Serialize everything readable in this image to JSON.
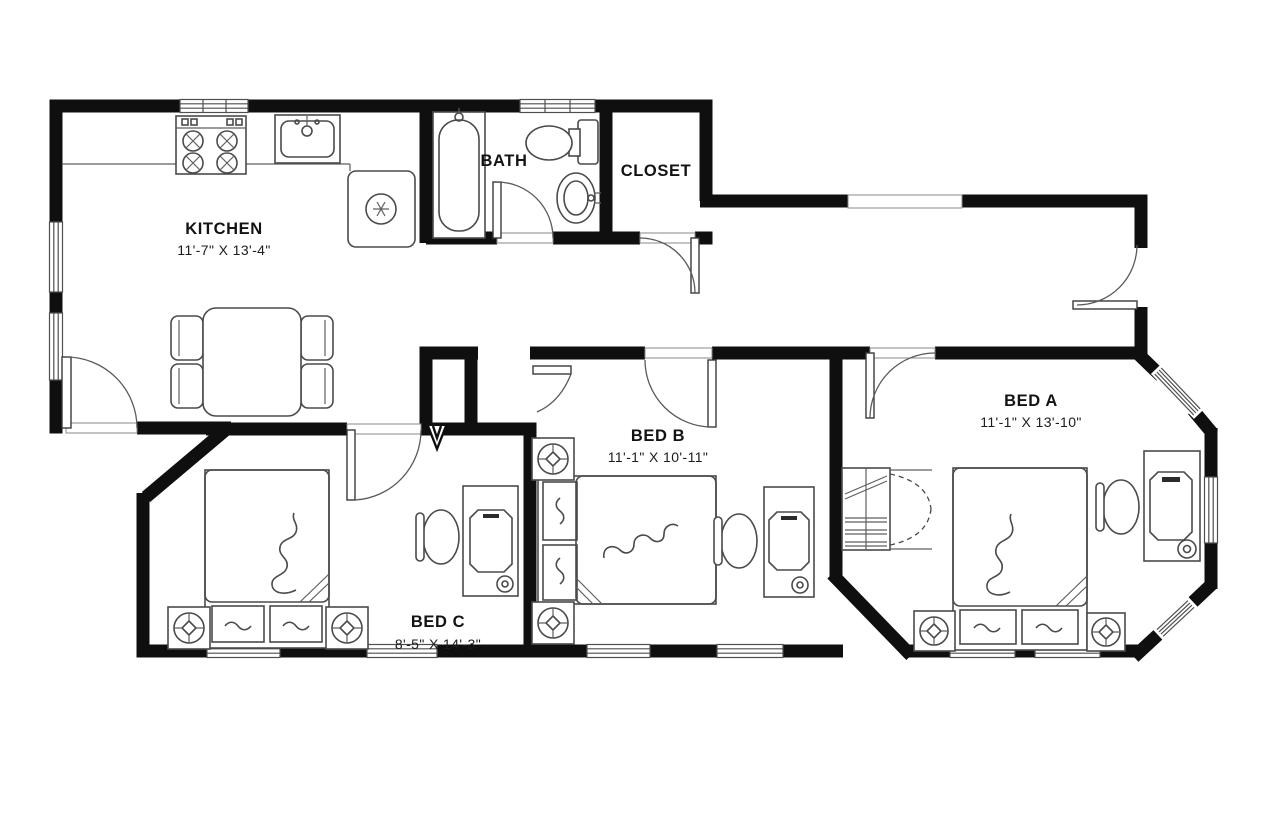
{
  "colors": {
    "background": "#ffffff",
    "wall": "#0f0f0f",
    "fixture_line": "#4a4a4a",
    "text": "#131313"
  },
  "rooms": {
    "kitchen": {
      "name": "KITCHEN",
      "dims": "11'-7\" X 13'-4\""
    },
    "bath": {
      "name": "BATH"
    },
    "closet": {
      "name": "CLOSET"
    },
    "bed_a": {
      "name": "BED A",
      "dims": "11'-1\" X 13'-10\""
    },
    "bed_b": {
      "name": "BED B",
      "dims": "11'-1\" X 10'-11\""
    },
    "bed_c": {
      "name": "BED C",
      "dims": "8'-5\" X 14'-3\""
    }
  },
  "fixtures": [
    "stove-icon",
    "kitchen-sink-icon",
    "refrigerator-icon",
    "dining-table-icon",
    "bathtub-icon",
    "toilet-icon",
    "bath-sink-icon",
    "bed-icon",
    "nightstand-lamp-icon",
    "desk-icon",
    "laptop-icon",
    "task-chair-icon",
    "closet-shelves-icon",
    "bifold-door-icon",
    "door-swing-icon",
    "window-icon"
  ]
}
